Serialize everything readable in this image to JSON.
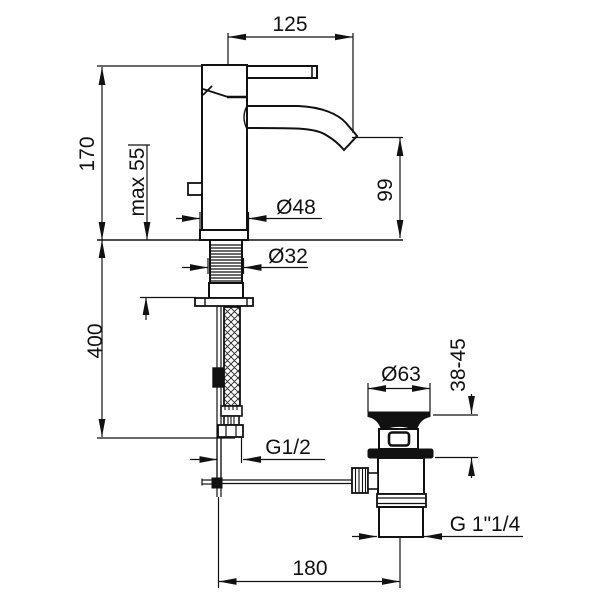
{
  "drawing": {
    "colors": {
      "lines": "#111111",
      "background": "#ffffff"
    }
  },
  "dimensions": {
    "spout_reach": "125",
    "fitting_height": "170",
    "max_deck_thickness": "max 55",
    "base_diameter": "Ø48",
    "spout_outlet_height": "99",
    "shank_diameter": "Ø32",
    "supply_hose_drop": "400",
    "supply_thread": "G1/2",
    "waste_flange_diameter": "Ø63",
    "waste_deck_thickness_range": "38-45",
    "waste_outlet_thread": "G 1\"1/4",
    "rod_to_waste_distance": "180"
  }
}
